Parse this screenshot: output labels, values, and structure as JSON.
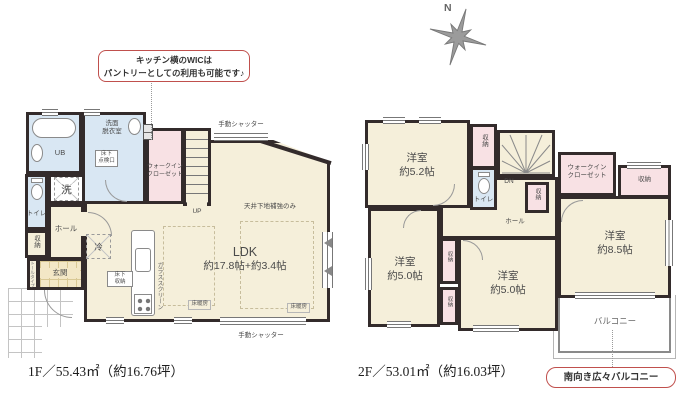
{
  "colors": {
    "wall": "#332b2b",
    "room_cream": "#f5efda",
    "closet_pink": "#f8e1e4",
    "wet_area_blue": "#d9e7f3",
    "accent_red": "#c0504d"
  },
  "compass": {
    "north": "N"
  },
  "callouts": {
    "wic_note1": "キッチン横のWICは",
    "wic_note2": "パントリーとしての利用も可能です♪",
    "balcony_note": "南向き広々バルコニー"
  },
  "floor1": {
    "area_label": "1F／55.43㎡（約16.76坪）",
    "labels": {
      "ub": "UB",
      "washroom1": "洗面",
      "washroom2": "脱衣室",
      "inspection1": "床下",
      "inspection2": "点検口",
      "laundry": "洗",
      "toilet": "トイレ",
      "storage": "収納",
      "hall": "ホール",
      "entrance": "玄関",
      "tall_type": "トールタイプ",
      "wic1": "ウォークイン",
      "wic2": "クローゼット",
      "up": "UP",
      "fridge": "冷",
      "underfloor1": "床下",
      "underfloor2": "収納",
      "glass_screen": "ガラススクリーン",
      "ldk": "LDK",
      "ldk_size": "約17.8帖+約3.4帖",
      "ceiling_note": "天井下地補強のみ",
      "floor_heating": "床暖房",
      "shutter": "手動シャッター"
    }
  },
  "floor2": {
    "area_label": "2F／53.01㎡（約16.03坪）",
    "labels": {
      "room": "洋室",
      "size52": "約5.2帖",
      "size50": "約5.0帖",
      "size85": "約8.5帖",
      "storage": "収納",
      "toilet": "トイレ",
      "dn": "DN",
      "hall": "ホール",
      "wic1": "ウォークイン",
      "wic2": "クローゼット",
      "balcony": "バルコニー"
    }
  }
}
